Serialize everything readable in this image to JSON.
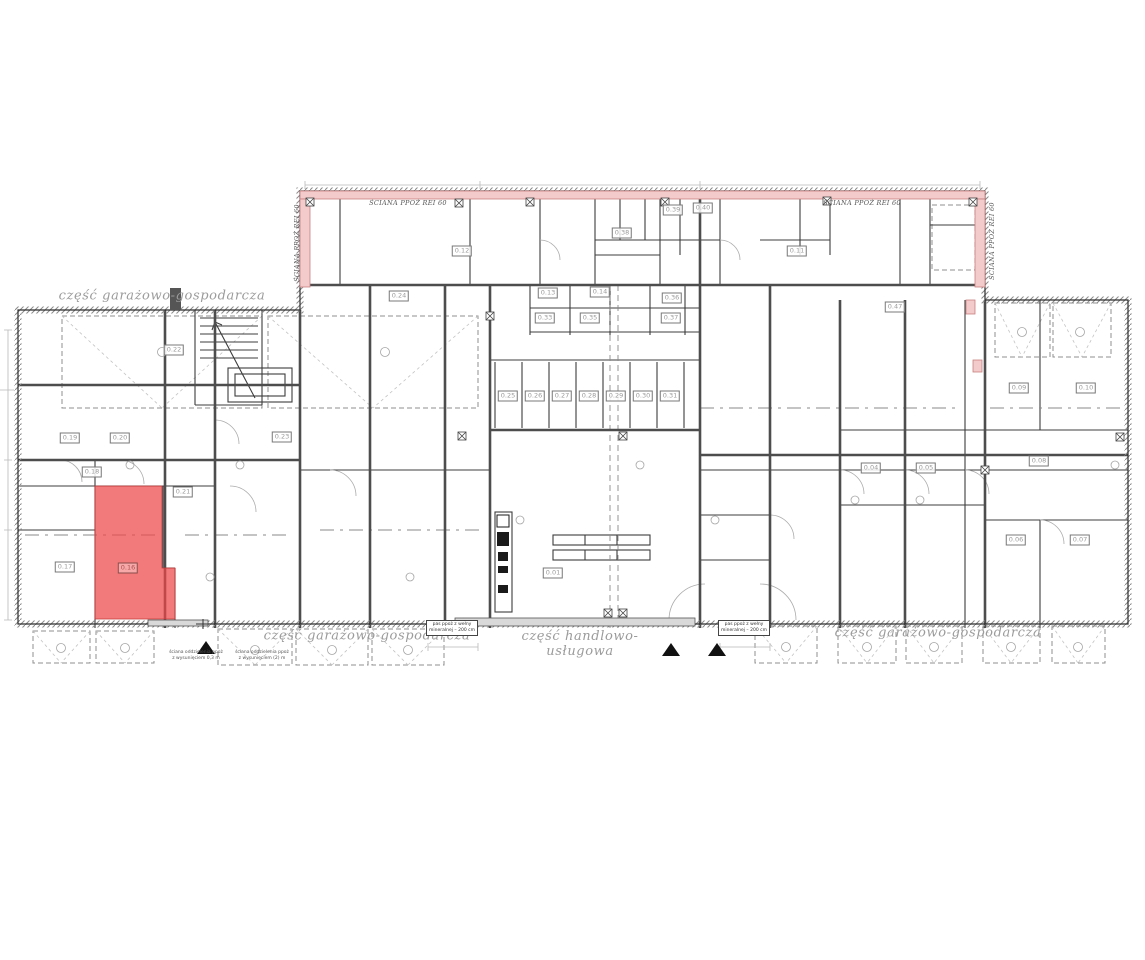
{
  "plan": {
    "highlight": {
      "room": "0.16",
      "color": "#ee4646",
      "opacity": 0.72
    },
    "firewall_band_color": "#f3cbcb",
    "area_labels": [
      {
        "text": "część garażowo-gospodarcza",
        "x": 162,
        "y": 296
      },
      {
        "text": "część garażowo-gospodarcza",
        "x": 367,
        "y": 636
      },
      {
        "text": "część handlowo-\nusługowa",
        "x": 580,
        "y": 644
      },
      {
        "text": "część garażowo-gospodarcza",
        "x": 938,
        "y": 633
      }
    ],
    "firewall_labels": [
      {
        "text": "ŚCIANA PPOŻ REI 60",
        "x": 408,
        "y": 203,
        "rot": 0
      },
      {
        "text": "ŚCIANA PPOŻ REI 60",
        "x": 862,
        "y": 203,
        "rot": 0
      },
      {
        "text": "ŚCIANA PPOŻ REI 60",
        "x": 297,
        "y": 243,
        "rot": -90
      },
      {
        "text": "ŚCIANA PPOŻ REI 60",
        "x": 992,
        "y": 241,
        "rot": -90
      }
    ],
    "notes": [
      {
        "lines": "ściana oddzielenia ppoż\nz wysunięciem 0,3 m",
        "x": 196,
        "y": 656
      },
      {
        "lines": "ściana oddzielenia ppoż\nz wysunięciem (2) m",
        "x": 262,
        "y": 656
      }
    ],
    "pas_labels": [
      {
        "lines": "pas ppoż z wełny\nmineralnej – 200 cm",
        "x": 452,
        "y": 628
      },
      {
        "lines": "pas ppoż z wełny\nmineralnej – 200 cm",
        "x": 744,
        "y": 628
      }
    ],
    "rooms": [
      {
        "n": "0.16",
        "x": 128,
        "y": 568,
        "hl": true
      },
      {
        "n": "0.17",
        "x": 65,
        "y": 567
      },
      {
        "n": "0.18",
        "x": 92,
        "y": 472
      },
      {
        "n": "0.19",
        "x": 70,
        "y": 438
      },
      {
        "n": "0.20",
        "x": 120,
        "y": 438
      },
      {
        "n": "0.21",
        "x": 183,
        "y": 492
      },
      {
        "n": "0.22",
        "x": 174,
        "y": 350
      },
      {
        "n": "0.23",
        "x": 282,
        "y": 437
      },
      {
        "n": "0.24",
        "x": 399,
        "y": 296
      },
      {
        "n": "0.12",
        "x": 462,
        "y": 251
      },
      {
        "n": "0.11",
        "x": 797,
        "y": 251
      },
      {
        "n": "0.13",
        "x": 548,
        "y": 293
      },
      {
        "n": "0.14",
        "x": 600,
        "y": 292
      },
      {
        "n": "0.33",
        "x": 545,
        "y": 318
      },
      {
        "n": "0.35",
        "x": 590,
        "y": 318
      },
      {
        "n": "0.36",
        "x": 672,
        "y": 298
      },
      {
        "n": "0.37",
        "x": 671,
        "y": 318
      },
      {
        "n": "0.38",
        "x": 622,
        "y": 233
      },
      {
        "n": "0.39",
        "x": 673,
        "y": 210
      },
      {
        "n": "0.40",
        "x": 703,
        "y": 208
      },
      {
        "n": "0.25",
        "x": 508,
        "y": 396
      },
      {
        "n": "0.26",
        "x": 535,
        "y": 396
      },
      {
        "n": "0.27",
        "x": 562,
        "y": 396
      },
      {
        "n": "0.28",
        "x": 589,
        "y": 396
      },
      {
        "n": "0.29",
        "x": 616,
        "y": 396
      },
      {
        "n": "0.30",
        "x": 643,
        "y": 396
      },
      {
        "n": "0.31",
        "x": 670,
        "y": 396
      },
      {
        "n": "0.01",
        "x": 553,
        "y": 573
      },
      {
        "n": "0.47",
        "x": 895,
        "y": 307
      },
      {
        "n": "0.04",
        "x": 871,
        "y": 468
      },
      {
        "n": "0.05",
        "x": 926,
        "y": 468
      },
      {
        "n": "0.08",
        "x": 1039,
        "y": 461
      },
      {
        "n": "0.09",
        "x": 1019,
        "y": 388
      },
      {
        "n": "0.10",
        "x": 1086,
        "y": 388
      },
      {
        "n": "0.06",
        "x": 1016,
        "y": 540
      },
      {
        "n": "0.07",
        "x": 1080,
        "y": 540
      }
    ]
  }
}
